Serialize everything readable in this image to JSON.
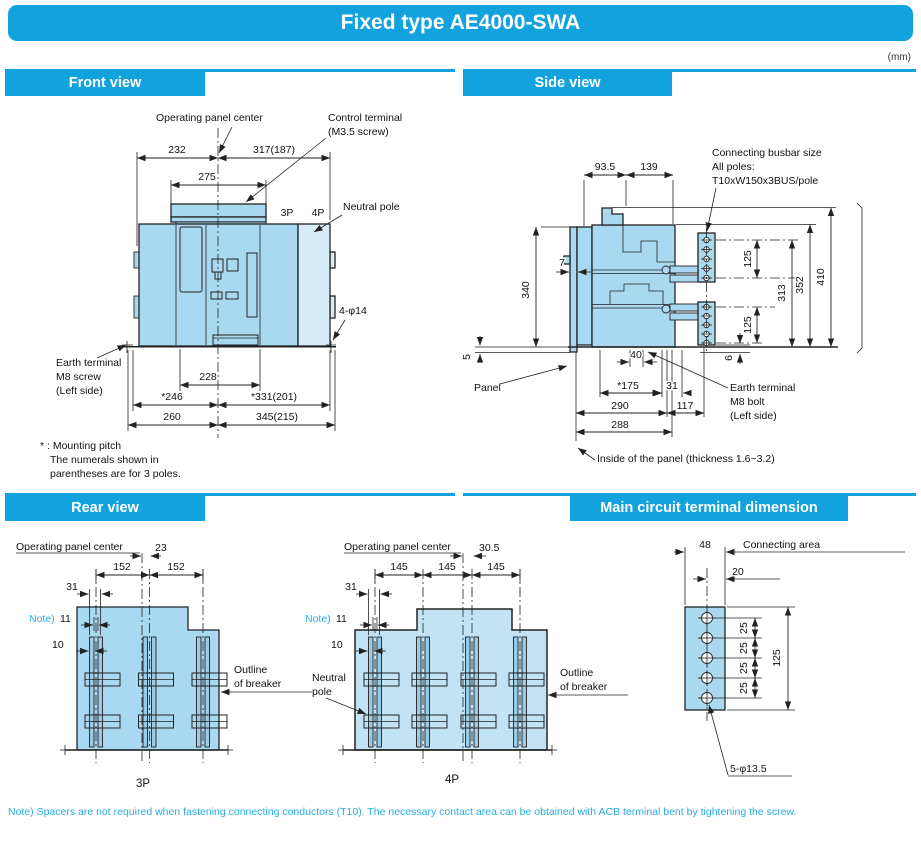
{
  "title": "Fixed type AE4000-SWA",
  "unit_note": "(mm)",
  "sections": {
    "front": "Front view",
    "side": "Side view",
    "rear": "Rear view",
    "terminal": "Main circuit terminal dimension"
  },
  "colors": {
    "accent": "#12a3df",
    "body_fill": "#a9d9f1",
    "neutral_pole_fill": "#d7ecf9",
    "rear_4p_fill": "#c3e3f5",
    "note_text": "#29abe2",
    "line": "#222222"
  },
  "front": {
    "operating_panel_center": "Operating panel center",
    "control_terminal_1": "Control terminal",
    "control_terminal_2": "(M3.5 screw)",
    "neutral_pole": "Neutral pole",
    "pole_3p": "3P",
    "pole_4p": "4P",
    "mount_holes": "4-φ14",
    "earth_1": "Earth terminal",
    "earth_2": "M8 screw",
    "earth_3": "(Left side)",
    "dim_232": "232",
    "dim_317": "317(187)",
    "dim_275": "275",
    "dim_228": "228",
    "dim_246": "*246",
    "dim_331": "*331(201)",
    "dim_260": "260",
    "dim_345": "345(215)",
    "fn_1": "* : Mounting pitch",
    "fn_2": "The numerals shown in",
    "fn_3": "parentheses are for 3 poles."
  },
  "side": {
    "busbar_1": "Connecting busbar size",
    "busbar_2": "All poles:",
    "busbar_3": "T10xW150x3BUS/pole",
    "panel": "Panel",
    "earth_1": "Earth terminal",
    "earth_2": "M8 bolt",
    "earth_3": "(Left side)",
    "inside_panel": "Inside of the panel (thickness 1.6~3.2)",
    "dim_93_5": "93.5",
    "dim_139": "139",
    "dim_340": "340",
    "dim_7": "7",
    "dim_125_top": "125",
    "dim_125_bottom": "125",
    "dim_313": "313",
    "dim_352": "352",
    "dim_410": "410",
    "dim_5": "5",
    "dim_40": "40",
    "dim_175": "*175",
    "dim_31": "31",
    "dim_290": "290",
    "dim_117": "117",
    "dim_288": "288",
    "dim_6": "6"
  },
  "rear_3p": {
    "operating_panel_center": "Operating panel center",
    "dim_23": "23",
    "dim_152_left": "152",
    "dim_152_right": "152",
    "dim_31": "31",
    "note": "Note)",
    "dim_11": "11",
    "dim_10": "10",
    "outline_1": "Outline",
    "outline_2": "of breaker",
    "caption": "3P"
  },
  "rear_4p": {
    "operating_panel_center": "Operating panel center",
    "dim_30_5": "30.5",
    "dim_145_a": "145",
    "dim_145_b": "145",
    "dim_145_c": "145",
    "dim_31": "31",
    "note": "Note)",
    "dim_11": "11",
    "dim_10": "10",
    "neutral_1": "Neutral",
    "neutral_2": "pole",
    "outline_1": "Outline",
    "outline_2": "of breaker",
    "caption": "4P"
  },
  "terminal": {
    "dim_48": "48",
    "connecting_area": "Connecting area",
    "dim_20": "20",
    "dim_25_1": "25",
    "dim_25_2": "25",
    "dim_25_3": "25",
    "dim_25_4": "25",
    "dim_125": "125",
    "holes": "5-φ13.5"
  },
  "footnote": "Note) Spacers are not required when fastening connecting conductors (T10). The necessary contact area can be obtained with ACB terminal bent by tightening the screw."
}
